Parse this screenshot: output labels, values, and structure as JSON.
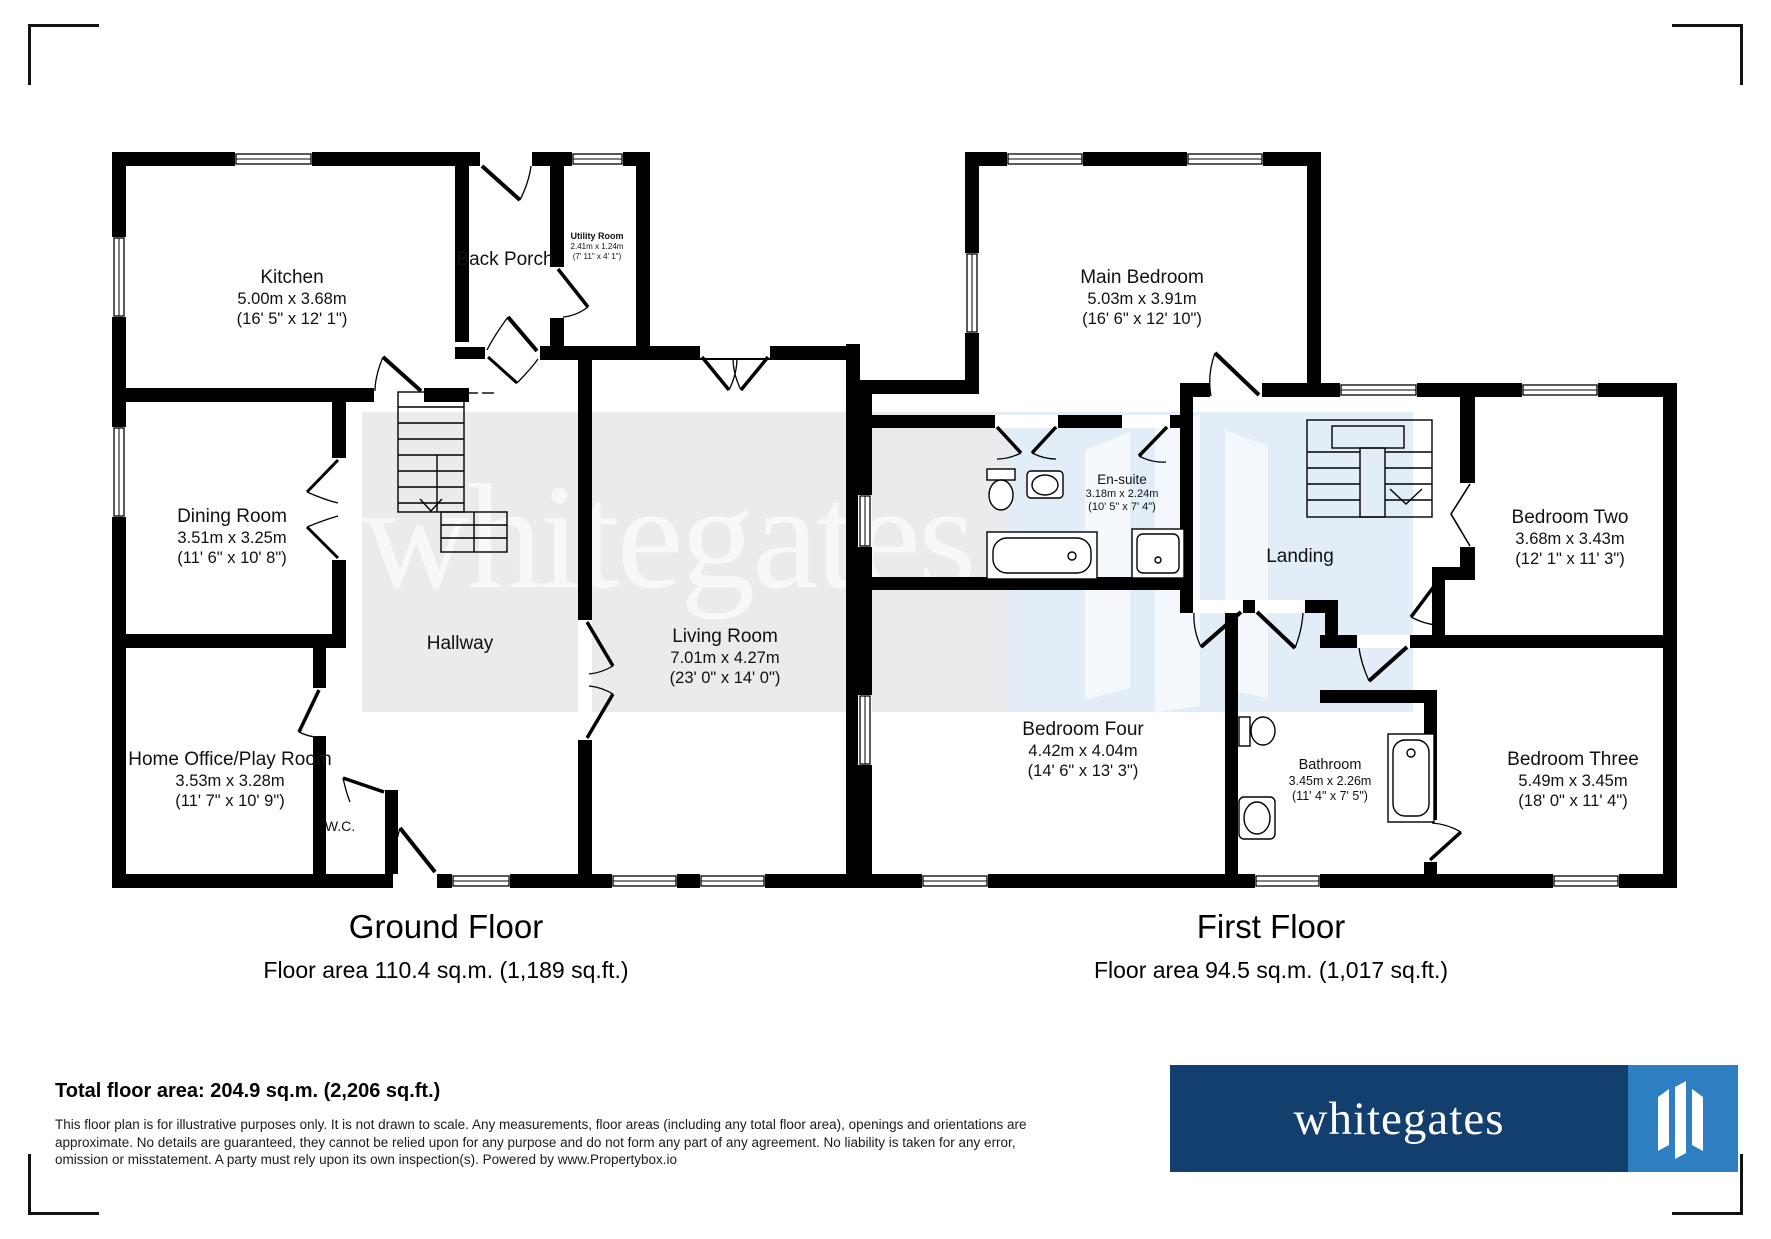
{
  "watermark": {
    "text": "whitegates"
  },
  "ground_floor": {
    "title": "Ground Floor",
    "area_line": "Floor area 110.4 sq.m. (1,189 sq.ft.)",
    "rooms": {
      "kitchen": {
        "name": "Kitchen",
        "metric": "5.00m x 3.68m",
        "imperial": "(16' 5\" x 12' 1\")"
      },
      "back_porch": {
        "name": "Back Porch"
      },
      "utility": {
        "name": "Utility Room",
        "metric": "2.41m x 1.24m",
        "imperial": "(7' 11\" x 4' 1\")"
      },
      "dining": {
        "name": "Dining Room",
        "metric": "3.51m x 3.25m",
        "imperial": "(11' 6\" x 10' 8\")"
      },
      "hallway": {
        "name": "Hallway"
      },
      "living": {
        "name": "Living Room",
        "metric": "7.01m x 4.27m",
        "imperial": "(23' 0\" x 14' 0\")"
      },
      "home_office": {
        "name": "Home Office/Play Room",
        "metric": "3.53m x 3.28m",
        "imperial": "(11' 7\" x 10' 9\")"
      },
      "wc": {
        "name": "W.C."
      }
    }
  },
  "first_floor": {
    "title": "First Floor",
    "area_line": "Floor area 94.5 sq.m. (1,017 sq.ft.)",
    "rooms": {
      "main_bedroom": {
        "name": "Main Bedroom",
        "metric": "5.03m x 3.91m",
        "imperial": "(16' 6\" x 12' 10\")"
      },
      "ensuite": {
        "name": "En-suite",
        "metric": "3.18m x 2.24m",
        "imperial": "(10' 5\" x 7' 4\")"
      },
      "landing": {
        "name": "Landing"
      },
      "bedroom_two": {
        "name": "Bedroom Two",
        "metric": "3.68m x 3.43m",
        "imperial": "(12' 1\" x 11' 3\")"
      },
      "bedroom_four": {
        "name": "Bedroom Four",
        "metric": "4.42m x 4.04m",
        "imperial": "(14' 6\" x 13' 3\")"
      },
      "bathroom": {
        "name": "Bathroom",
        "metric": "3.45m x 2.26m",
        "imperial": "(11' 4\" x 7' 5\")"
      },
      "bedroom_three": {
        "name": "Bedroom Three",
        "metric": "5.49m x 3.45m",
        "imperial": "(18' 0\" x 11' 4\")"
      }
    }
  },
  "footer": {
    "total": "Total floor area: 204.9 sq.m. (2,206 sq.ft.)",
    "disclaimer_lines": [
      "This floor plan is for illustrative purposes only. It is not drawn to scale. Any measurements, floor areas (including any total floor area), openings and orientations are",
      "approximate. No details are guaranteed, they cannot be relied upon for any purpose and do not form any part of any agreement. No liability is taken for any error,",
      "omission or misstatement. A party must rely upon its own inspection(s). Powered by www.Propertybox.io"
    ]
  },
  "logo": {
    "text": "whitegates"
  },
  "colors": {
    "wall": "#000000",
    "watermark_gray": "#e9ebec",
    "watermark_blue": "#e2edf8",
    "logo_navy": "#123f6e",
    "logo_blue": "#2e7fc2"
  }
}
